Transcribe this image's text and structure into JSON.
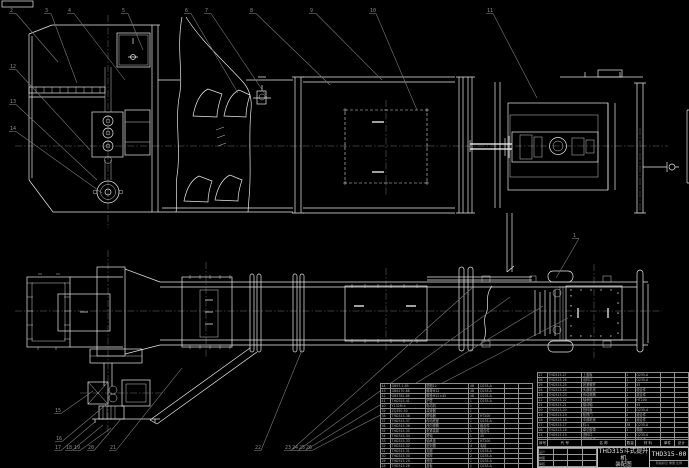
{
  "title_block": {
    "product_title": "THD315斗式提升机",
    "drawing_type": "装配图",
    "drawing_no": "THD315-00",
    "bottom_note": "阶段标记 重量 比例",
    "sig_rows": [
      [
        "设计",
        "",
        "",
        ""
      ],
      [
        "制图",
        "",
        "",
        ""
      ],
      [
        "审核",
        "",
        "",
        ""
      ]
    ]
  },
  "bom": {
    "header": [
      [
        "序号",
        "代  号",
        "名  称",
        "数量",
        "材  料",
        "单件",
        "总计",
        "备注"
      ]
    ],
    "right_rows": [
      [
        "27",
        "THD315-27",
        "上盖板",
        "1",
        "Q235-A",
        "",
        "",
        ""
      ],
      [
        "26",
        "THD315-26",
        "出料口",
        "1",
        "Q235-A",
        "",
        "",
        ""
      ],
      [
        "25",
        "THD315-25",
        "张紧螺杆",
        "2",
        "45",
        "",
        "",
        ""
      ],
      [
        "24",
        "THD315-24",
        "头部机壳",
        "1",
        "组合件",
        "",
        "",
        ""
      ],
      [
        "23",
        "THD315-23",
        "传动滚筒",
        "1",
        "组合件",
        "",
        "",
        ""
      ],
      [
        "22",
        "THD315-22",
        "轴承座",
        "2",
        "HT200",
        "",
        "",
        ""
      ],
      [
        "21",
        "THD315-21",
        "驱动轴",
        "1",
        "45",
        "",
        "",
        ""
      ],
      [
        "20",
        "THD315-20",
        "挡料板",
        "1",
        "Q235-A",
        "",
        "",
        ""
      ],
      [
        "19",
        "THD315-19",
        "检视门",
        "2",
        "组合件",
        "",
        "",
        ""
      ],
      [
        "18",
        "THD315-18",
        "中部机壳",
        "4",
        "组合件",
        "",
        "",
        ""
      ],
      [
        "17",
        "THD315-17",
        "料斗",
        "38",
        "Q235-A",
        "",
        "",
        ""
      ],
      [
        "16",
        "THD315-16",
        "牵引胶带",
        "1",
        "橡胶",
        "",
        "",
        ""
      ],
      [
        "15",
        "THD315-15",
        "进料口",
        "1",
        "Q235-A",
        "",
        "",
        ""
      ],
      [
        "14",
        "THD315-14",
        "底部机壳",
        "1",
        "组合件",
        "",
        "",
        ""
      ]
    ],
    "left_rows": [
      [
        "44",
        "GB97.1-85",
        "垫圈12",
        "48",
        "Q235-A",
        "",
        "",
        ""
      ],
      [
        "43",
        "GB6170-86",
        "螺母M12",
        "48",
        "Q235-A",
        "",
        "",
        ""
      ],
      [
        "42",
        "GB5782-86",
        "螺栓M12×45",
        "48",
        "Q235-A",
        "",
        "",
        ""
      ],
      [
        "41",
        "THD315-41",
        "护罩",
        "1",
        "Q235-A",
        "",
        "",
        ""
      ],
      [
        "40",
        "Y132M-4",
        "电动机",
        "1",
        "",
        "",
        "",
        "外购"
      ],
      [
        "39",
        "ZQ350-50",
        "减速器",
        "1",
        "",
        "",
        "",
        "外购"
      ],
      [
        "38",
        "THD315-38",
        "联轴器",
        "2",
        "HT200",
        "",
        "",
        ""
      ],
      [
        "37",
        "THD315-37",
        "传动底座",
        "1",
        "Q235-A",
        "",
        "",
        ""
      ],
      [
        "36",
        "THD315-36",
        "改向滚筒",
        "1",
        "组合件",
        "",
        "",
        ""
      ],
      [
        "35",
        "THD315-35",
        "张紧装置",
        "1",
        "组合件",
        "",
        "",
        ""
      ],
      [
        "34",
        "THD315-34",
        "尾轴",
        "1",
        "45",
        "",
        "",
        ""
      ],
      [
        "33",
        "THD315-33",
        "轴承盖",
        "2",
        "HT200",
        "",
        "",
        ""
      ],
      [
        "32",
        "THD315-32",
        "密封圈",
        "4",
        "毛毡",
        "",
        "",
        ""
      ],
      [
        "31",
        "THD315-31",
        "支腿",
        "2",
        "Q235-A",
        "",
        "",
        ""
      ],
      [
        "30",
        "THD315-30",
        "斜撑",
        "2",
        "Q235-A",
        "",
        "",
        ""
      ],
      [
        "29",
        "THD315-29",
        "底座",
        "1",
        "Q235-A",
        "",
        "",
        ""
      ],
      [
        "28",
        "THD315-28",
        "盖板",
        "1",
        "Q235-A",
        "",
        "",
        ""
      ]
    ]
  },
  "callouts": {
    "top": [
      {
        "label": "2",
        "x": 10,
        "y": 12,
        "tx": 58,
        "ty": 62
      },
      {
        "label": "3",
        "x": 45,
        "y": 12,
        "tx": 77,
        "ty": 83
      },
      {
        "label": "4",
        "x": 68,
        "y": 12,
        "tx": 125,
        "ty": 80
      },
      {
        "label": "5",
        "x": 122,
        "y": 12,
        "tx": 143,
        "ty": 50
      },
      {
        "label": "6",
        "x": 185,
        "y": 12,
        "tx": 238,
        "ty": 93
      },
      {
        "label": "7",
        "x": 205,
        "y": 12,
        "tx": 267,
        "ty": 97
      },
      {
        "label": "8",
        "x": 250,
        "y": 12,
        "tx": 330,
        "ty": 85
      },
      {
        "label": "9",
        "x": 310,
        "y": 12,
        "tx": 382,
        "ty": 80
      },
      {
        "label": "10",
        "x": 370,
        "y": 12,
        "tx": 417,
        "ty": 110
      },
      {
        "label": "11",
        "x": 487,
        "y": 12,
        "tx": 537,
        "ty": 98
      }
    ],
    "left": [
      {
        "label": "12",
        "x": 10,
        "y": 68,
        "tx": 90,
        "ty": 150
      },
      {
        "label": "13",
        "x": 10,
        "y": 103,
        "tx": 97,
        "ty": 180
      },
      {
        "label": "14",
        "x": 10,
        "y": 130,
        "tx": 102,
        "ty": 193
      }
    ],
    "bottom": [
      {
        "label": "15",
        "x": 55,
        "y": 412,
        "tx": 93,
        "ty": 391
      },
      {
        "label": "16",
        "x": 56,
        "y": 440,
        "tx": 108,
        "ty": 403
      },
      {
        "label": "17",
        "x": 55,
        "y": 449,
        "tx": 96,
        "ty": 421
      },
      {
        "label": "18",
        "x": 66,
        "y": 449,
        "tx": 103,
        "ty": 425
      },
      {
        "label": "19",
        "x": 74,
        "y": 449,
        "tx": 111,
        "ty": 428
      },
      {
        "label": "20",
        "x": 88,
        "y": 449,
        "tx": 121,
        "ty": 419
      },
      {
        "label": "21",
        "x": 110,
        "y": 449,
        "tx": 182,
        "ty": 368
      },
      {
        "label": "22",
        "x": 255,
        "y": 449,
        "tx": 302,
        "ty": 350
      },
      {
        "label": "23",
        "x": 285,
        "y": 449,
        "tx": 472,
        "ty": 288
      },
      {
        "label": "24",
        "x": 292,
        "y": 449,
        "tx": 510,
        "ty": 297
      },
      {
        "label": "25",
        "x": 299,
        "y": 449,
        "tx": 543,
        "ty": 306
      },
      {
        "label": "26",
        "x": 306,
        "y": 449,
        "tx": 568,
        "ty": 318
      }
    ],
    "right": [
      {
        "label": "1",
        "x": 573,
        "y": 237,
        "tx": 556,
        "ty": 278
      }
    ]
  },
  "colors": {
    "background": "#000000",
    "line": "#e9e9e9",
    "leader": "#7a7a7a",
    "table_text": "#b5b5b5",
    "logo": "#3f3f3f"
  }
}
